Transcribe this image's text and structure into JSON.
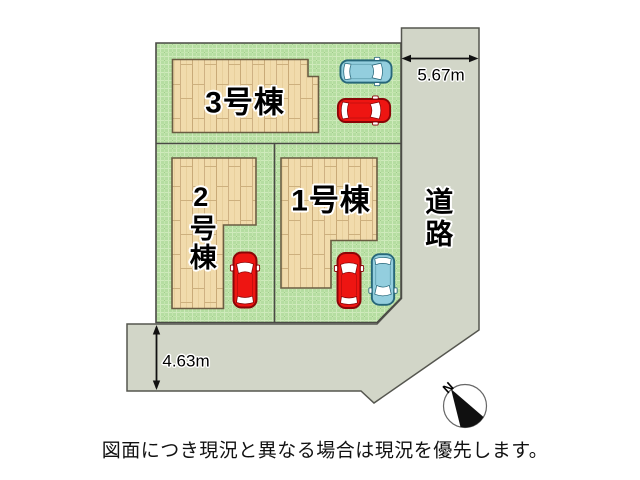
{
  "site_plan": {
    "buildings": [
      {
        "id": "building-3",
        "label": "3号棟",
        "orientation": "horizontal"
      },
      {
        "id": "building-2",
        "label": "2号棟",
        "orientation": "vertical"
      },
      {
        "id": "building-1",
        "label": "1号棟",
        "orientation": "horizontal"
      }
    ],
    "road": {
      "label": "道路",
      "orientation": "vertical"
    },
    "dimensions": [
      {
        "id": "right-road-width",
        "label": "5.67m"
      },
      {
        "id": "bottom-road-width",
        "label": "4.63m"
      }
    ],
    "compass": {
      "north_label": "N"
    },
    "cars": [
      {
        "id": "car-top-blue",
        "color": "blue"
      },
      {
        "id": "car-top-red",
        "color": "red"
      },
      {
        "id": "car-lot2-red",
        "color": "red"
      },
      {
        "id": "car-lot1-red",
        "color": "red"
      },
      {
        "id": "car-lot1-blue",
        "color": "blue"
      }
    ],
    "colors": {
      "lot_green": "#b5dda1",
      "grass_line_light": "#cfeabc",
      "road_gray": "#d2d6c8",
      "building_wood": "#f1dbac",
      "wood_line": "#c9aa78",
      "outline_dark": "#4a4a45",
      "car_red": "#ee1512",
      "car_blue": "#93cede",
      "window_white": "#ffffff"
    }
  },
  "footer": {
    "disclaimer": "図面につき現況と異なる場合は現況を優先します。"
  }
}
